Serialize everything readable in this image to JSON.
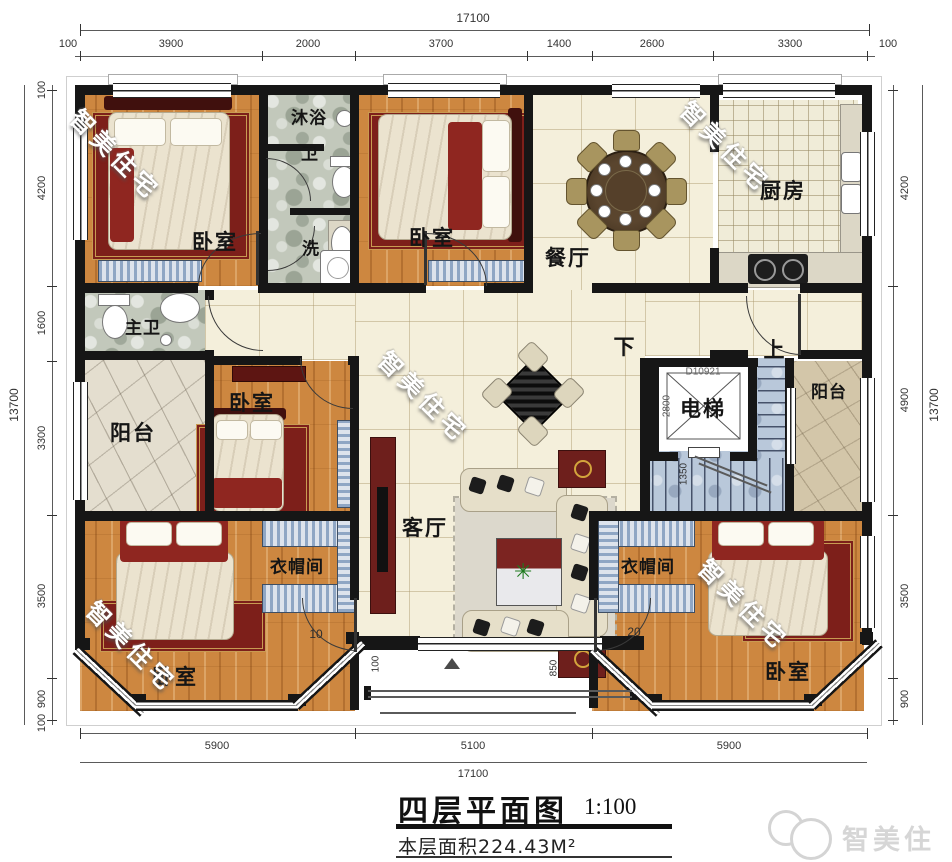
{
  "title_block": {
    "title": "四层平面图",
    "scale": "1:100",
    "area": "本层面积224.43M²"
  },
  "brand": {
    "logo_text": "智美住宅",
    "watermark_text": "智美住宅"
  },
  "dimensions": {
    "top_total": "17100",
    "top": [
      "100",
      "3900",
      "2000",
      "3700",
      "1400",
      "2600",
      "3300",
      "100"
    ],
    "bottom": [
      "5900",
      "5100",
      "5900"
    ],
    "bottom_total": "17100",
    "left": [
      "100",
      "4200",
      "1600",
      "3300",
      "3500",
      "900",
      "100"
    ],
    "left_total": "13700",
    "right": [
      "4200",
      "4900",
      "3500",
      "900"
    ],
    "right_total": "13700"
  },
  "rooms": {
    "bedroom_top_left": "卧室",
    "shower": "沐浴",
    "wc": "卫",
    "wash": "洗",
    "bedroom_top_mid": "卧室",
    "dining": "餐厅",
    "kitchen": "厨房",
    "master_bath": "主卫",
    "balcony_left": "阳台",
    "bedroom_mid": "卧室",
    "living": "客厅",
    "down": "下",
    "up": "上",
    "elevator": "电梯",
    "balcony_right": "阳台",
    "cloakroom_left": "衣帽间",
    "cloakroom_right": "衣帽间",
    "bedroom_bottom_left": "卧室",
    "bedroom_bottom_right": "卧室"
  },
  "annotations": {
    "elevator_code": "D10921",
    "elevator_width": "2800",
    "stair_width": "1350",
    "door_left": "10",
    "door_right": "20",
    "front_dim_left": "100",
    "front_dim_right": "850"
  },
  "colors": {
    "wall": "#161616",
    "wood": "#cd8740",
    "tile": "#f4efdb",
    "stone": "#c2c8bb",
    "stair": "#b9c8da",
    "accent_red": "#7d1f1a"
  }
}
